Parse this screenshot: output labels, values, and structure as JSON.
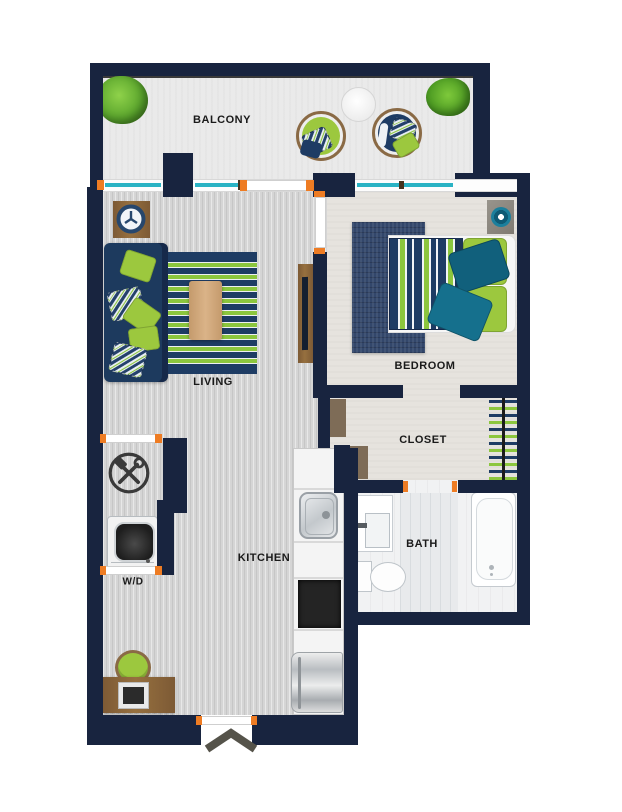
{
  "title": "Studio apartment floor plan",
  "rooms": {
    "balcony": {
      "label": "BALCONY"
    },
    "living": {
      "label": "LIVING"
    },
    "bedroom": {
      "label": "BEDROOM"
    },
    "closet": {
      "label": "CLOSET"
    },
    "kitchen": {
      "label": "KITCHEN"
    },
    "bath": {
      "label": "BATH"
    },
    "laundry": {
      "label": "W/D"
    }
  },
  "colors": {
    "wall": "#18243f",
    "window": "#2ab3c4",
    "door-marker": "#ee7c23",
    "accent-green": "#9cc83e",
    "accent-navy": "#1e3c64",
    "accent-teal": "#136a85",
    "wood": "#8a6a45"
  },
  "icons": {
    "wall-clock": "clock face with spokes",
    "tools": "crossed hammer and wrench in circle",
    "entry-arrow": "upward chevron at entry door",
    "washer": "top-view washing machine drum"
  }
}
